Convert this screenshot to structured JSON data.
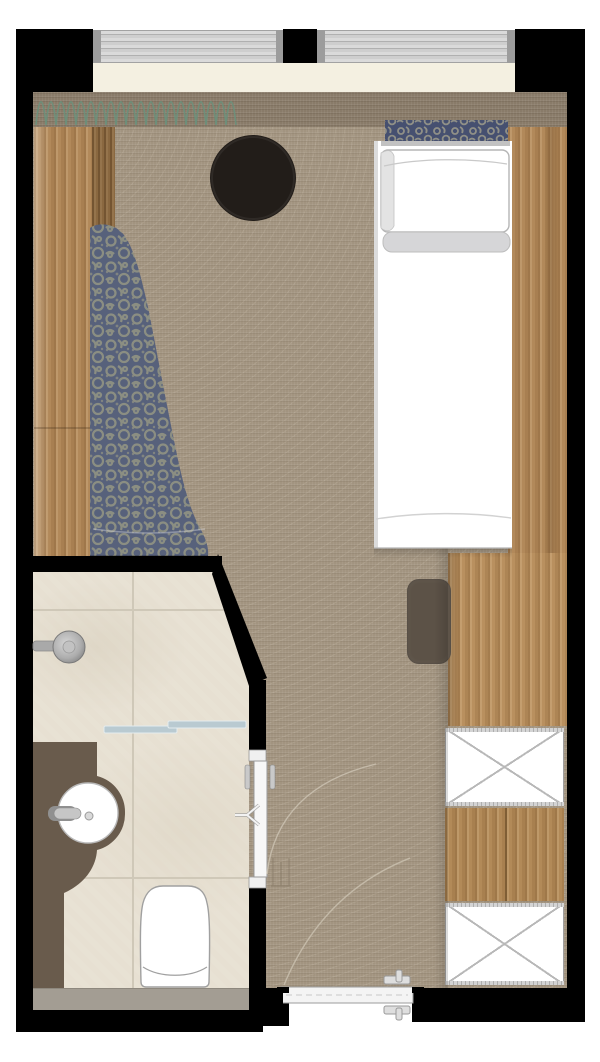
{
  "meta": {
    "title": "Hotel guest room floor plan",
    "drawing_type": "architectural plan, top-down view",
    "visible_text": "none"
  },
  "palette": {
    "wall": "#000000",
    "carpet": "#a29480",
    "carpet_dark_band": "#897b69",
    "window_blind": "#c6c6c6",
    "window_frame": "#9c9c9c",
    "sill": "#f4f0e1",
    "wood": "#b2895a",
    "wood_dark": "#8a6840",
    "tile": "#e7e0d2",
    "vanity": "#695b4c",
    "bench": "#a39d93",
    "fabric_base": "#57617b",
    "fabric_motif": "#8e9083",
    "glass_partition": "#b9cad1",
    "side_table": "#221d19",
    "desk_chair": "#5c5247",
    "curtain_symbol": "#69927d",
    "fixture_white": "#ffffff"
  },
  "labels": {
    "plan": "Hotel guest room floor plan",
    "windows": "windows with blinds",
    "curtain": "curtain symbol",
    "bed": "single bed with pillow",
    "runner": "patterned bed runner",
    "chaise": "upholstered chaise longue",
    "table": "round black side table",
    "left_wardrobe": "wardrobe panel along left wall",
    "right_panel": "wardrobe panel beside bed",
    "desk": "desk",
    "chair": "desk chair",
    "closet": "closet with crossed shelf symbols",
    "bathroom": "bathroom",
    "shower": "shower head",
    "glass": "glass shower partition",
    "vanity": "vanity counter",
    "sink": "round washbasin",
    "toilet": "toilet",
    "bench_strip": "bathroom threshold strip",
    "bath_door": "bathroom door with swing arc",
    "entry_door": "entrance door with swing arc"
  },
  "inventory": {
    "rooms": [
      "bedroom",
      "bathroom",
      "entry corridor"
    ],
    "window_count": 2,
    "door_count": 2,
    "closet_shelf_boxes": 2
  }
}
